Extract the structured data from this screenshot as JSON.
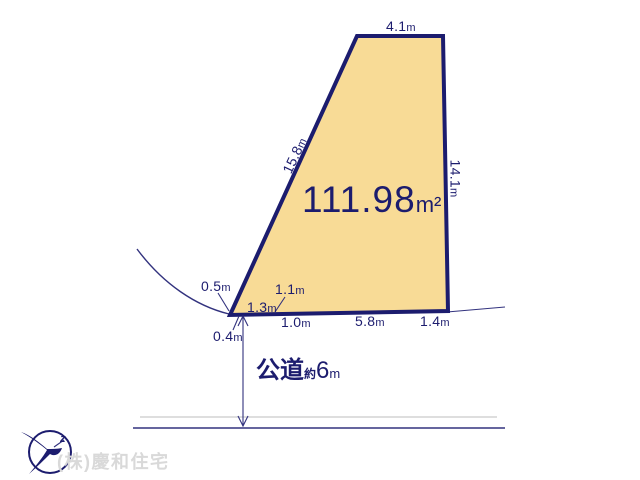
{
  "colors": {
    "plot_fill": "#f8db96",
    "outline_navy": "#1c1c6e",
    "thin_line": "#32327e",
    "light_gray_line": "#cbcbcb",
    "company_gray": "#d9d9d9"
  },
  "plot": {
    "area": {
      "value": "111.98",
      "unit": "m²"
    },
    "measurements": {
      "top": {
        "value": "4.1",
        "unit": "m"
      },
      "left_diagonal": {
        "value": "15.8",
        "unit": "m"
      },
      "right": {
        "value": "14.1",
        "unit": "m"
      },
      "corner_a": {
        "value": "0.5",
        "unit": "m"
      },
      "corner_b": {
        "value": "1.1",
        "unit": "m"
      },
      "corner_c": {
        "value": "1.3",
        "unit": "m"
      },
      "bottom_a": {
        "value": "1.0",
        "unit": "m"
      },
      "bottom_b": {
        "value": "5.8",
        "unit": "m"
      },
      "bottom_c": {
        "value": "1.4",
        "unit": "m"
      },
      "corner_d": {
        "value": "0.4",
        "unit": "m"
      }
    }
  },
  "road": {
    "name": "公道",
    "approx": "約",
    "value": "6",
    "unit": "m"
  },
  "footer": {
    "company_name": "(株)慶和住宅",
    "logo": "crane-bird-logo"
  }
}
